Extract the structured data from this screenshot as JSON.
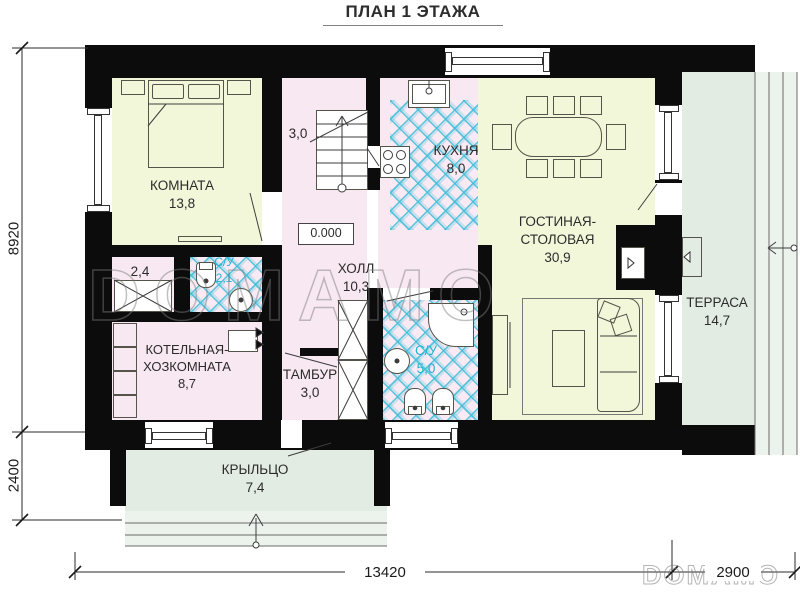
{
  "title": "ПЛАН 1 ЭТАЖА",
  "watermark": {
    "center": "DOMAMO",
    "bottom": "DOMAMO"
  },
  "rooms": {
    "bedroom": {
      "name": "КОМНАТА",
      "area": "13,8"
    },
    "stairs": {
      "area": "3,0"
    },
    "kitchen": {
      "name": "КУХНЯ",
      "area": "8,0"
    },
    "living": {
      "name": "ГОСТИНАЯ-СТОЛОВАЯ",
      "area": "30,9"
    },
    "terrace": {
      "name": "ТЕРРАСА",
      "area": "14,7"
    },
    "hall": {
      "name": "ХОЛЛ",
      "area": "10,3"
    },
    "closet": {
      "area": "2,4"
    },
    "bathroom_small": {
      "name": "С/У",
      "area": "2,1"
    },
    "bathroom": {
      "name": "С/У",
      "area": "5,0"
    },
    "boiler": {
      "name": "КОТЕЛЬНАЯ-ХОЗКОМНАТА",
      "area": "8,7"
    },
    "tambour": {
      "name": "ТАМБУР",
      "area": "3,0"
    },
    "porch": {
      "name": "КРЫЛЬЦО",
      "area": "7,4"
    }
  },
  "level_mark": "0.000",
  "dimensions": {
    "height_main": "8920",
    "height_porch": "2400",
    "width_main": "13420",
    "width_terrace": "2900"
  },
  "colors": {
    "wall": "#0c0c0c",
    "room_warm": "#f3f7da",
    "room_pink": "#f8e8f2",
    "outdoor_green": "#e2ece2",
    "tile_line": "#3ebed8",
    "bath_label": "#23b2d0"
  }
}
